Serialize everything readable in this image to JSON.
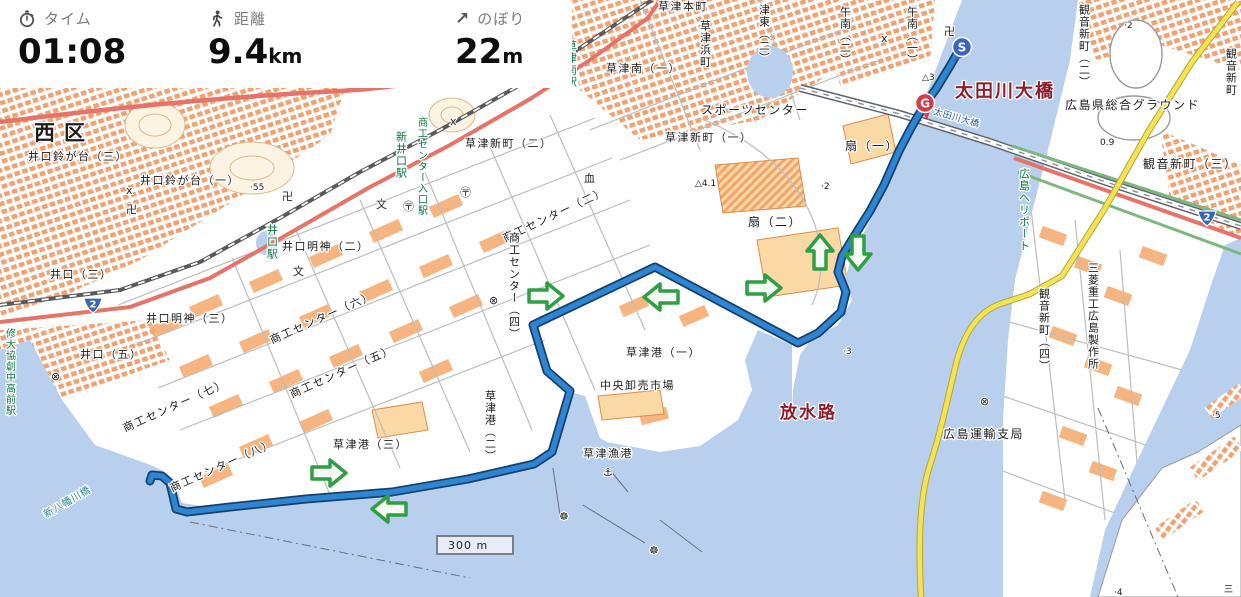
{
  "header": {
    "time": {
      "icon": "stopwatch-icon",
      "label": "タイム",
      "value": "01:08",
      "unit": ""
    },
    "distance": {
      "icon": "pedestrian-icon",
      "label": "距離",
      "value": "9.4",
      "unit": "km"
    },
    "ascent": {
      "icon": "up-right-arrow-icon",
      "label": "のぼり",
      "value": "22",
      "unit": "m",
      "icon_glyph": "↗"
    }
  },
  "map": {
    "scale_label": "300 m",
    "start_marker": "S",
    "goal_marker": "G",
    "route_shield": "2",
    "labels": {
      "nishiku": {
        "text": "西区"
      },
      "suzugadai3": {
        "text": "井口鈴が台（三）"
      },
      "suzugadai1": {
        "text": "井口鈴が台（一）"
      },
      "inokuchi3": {
        "text": "井口（三）"
      },
      "inokuchi5": {
        "text": "井口（五）"
      },
      "myojin3": {
        "text": "井口明神（三）"
      },
      "myojin2": {
        "text": "井口明神（二）"
      },
      "inokuchieki": {
        "text": "井口駅"
      },
      "shudaieki": {
        "text": "修大協創中高前駅"
      },
      "shininokuchi": {
        "text": "新井口駅"
      },
      "iriguchieki": {
        "text": "商工センター入口駅"
      },
      "kusatsuminamieki": {
        "text": "草津南駅"
      },
      "kusatsuhonmachi": {
        "text": "草津本町"
      },
      "kusatsuminami1": {
        "text": "草津南（一）"
      },
      "hamacho": {
        "text": "草津浜町"
      },
      "higashi2": {
        "text": "津東（二）"
      },
      "gonan2": {
        "text": "午南（二）"
      },
      "gonan1": {
        "text": "午南（一）"
      },
      "sports": {
        "text": "スポーツセンター"
      },
      "shinmachi1": {
        "text": "草津新町（一）"
      },
      "shinmachi2": {
        "text": "草津新町（二）"
      },
      "ougi1": {
        "text": "扇（一）"
      },
      "ougi2": {
        "text": "扇（二）"
      },
      "sc2": {
        "text": "商工センター（二）"
      },
      "sc4": {
        "text": "商工センター（四）"
      },
      "sc5": {
        "text": "商工センター（五）"
      },
      "sc6": {
        "text": "商工センター（六）"
      },
      "sc7": {
        "text": "商工センター（七）"
      },
      "sc8": {
        "text": "商工センター（八）"
      },
      "ko1": {
        "text": "草津港（一）"
      },
      "ko2": {
        "text": "草津港（二）"
      },
      "ko3": {
        "text": "草津港（三）"
      },
      "ichiba": {
        "text": "中央卸売市場"
      },
      "gyoko": {
        "text": "草津漁港"
      },
      "hosuiro": {
        "text": "放水路"
      },
      "otagawa": {
        "text": "太田川大橋"
      },
      "otagawa_small": {
        "text": "太田川大橋"
      },
      "yahatabashi": {
        "text": "新八幡川橋"
      },
      "heliport": {
        "text": "広島ヘリポート"
      },
      "kannon2": {
        "text": "観音新町（二）"
      },
      "kannon3": {
        "text": "観音新町（三）"
      },
      "kannon3v": {
        "text": "観音新町"
      },
      "kannon4": {
        "text": "観音新町（四）"
      },
      "mitsubishi": {
        "text": "三菱重工広島製作所"
      },
      "unyu": {
        "text": "広島運輸支局"
      },
      "ground": {
        "text": "広島県総合グラウンド"
      }
    },
    "elevations": {
      "e55": "·55",
      "e3": "△3",
      "e41": "△4.1",
      "e3b": "·3",
      "e09": "0.9",
      "e2": "·2",
      "e2b": "·2",
      "e5": "·5",
      "e4": "·4",
      "san": "三"
    },
    "symbols": {
      "m1": "卍",
      "m2": "卍",
      "m3": "卍",
      "p1": "〶",
      "p2": "〶",
      "s1": "文",
      "s2": "文",
      "x1": "x",
      "x2": "x",
      "x3": "x",
      "k1": "⊗",
      "k2": "⊗",
      "k3": "⊗",
      "a1": "⚓",
      "w1": "☸",
      "w2": "☸",
      "mu1": "血"
    },
    "colors": {
      "route": "#2e86d3",
      "arrow": "#2f9e44",
      "water": "#b9cfee",
      "start_pin": "#3b63c4",
      "goal_pin": "#d93a49",
      "maroon_label": "#8f1d2c",
      "station_green": "#0a7a40",
      "road_yellow": "#f3e455",
      "road_red": "#e57368"
    }
  }
}
